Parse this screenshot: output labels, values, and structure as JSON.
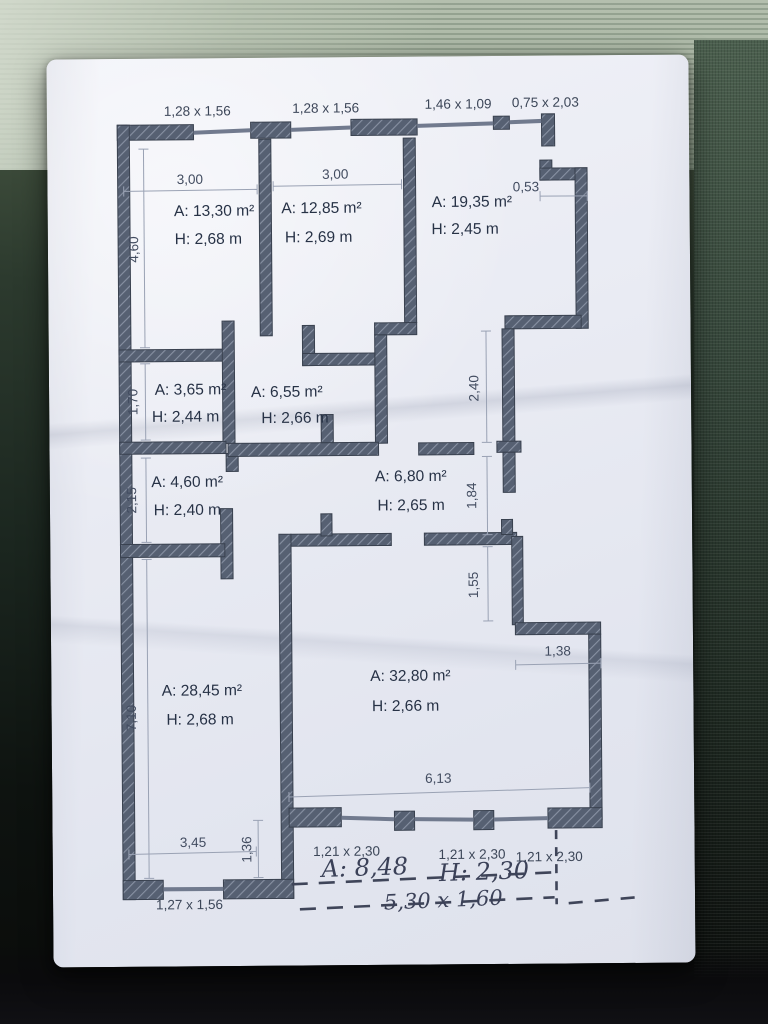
{
  "plan": {
    "top_windows": [
      "1,28 x 1,56",
      "1,28 x 1,56",
      "1,46 x 1,09",
      "0,75 x 2,03"
    ],
    "rooms": [
      {
        "area": "A: 13,30 m²",
        "height": "H: 2,68 m"
      },
      {
        "area": "A: 12,85 m²",
        "height": "H: 2,69 m"
      },
      {
        "area": "A: 19,35 m²",
        "height": "H: 2,45 m"
      },
      {
        "area": "A: 3,65 m²",
        "height": "H: 2,44 m"
      },
      {
        "area": "A: 6,55 m²",
        "height": "H: 2,66 m"
      },
      {
        "area": "A: 4,60 m²",
        "height": "H: 2,40 m"
      },
      {
        "area": "A: 6,80 m²",
        "height": "H: 2,65 m"
      },
      {
        "area": "A: 28,45 m²",
        "height": "H: 2,68 m"
      },
      {
        "area": "A: 32,80 m²",
        "height": "H: 2,66 m"
      }
    ],
    "dimensions": {
      "room1_width": "3,00",
      "room2_width": "3,00",
      "top_right_step": "0,53",
      "left_chain": [
        "4,60",
        "1,70",
        "2,15",
        "7,10"
      ],
      "right_chain": [
        "2,40",
        "1,84",
        "1,55"
      ],
      "right_step": "1,38",
      "room9_width": "6,13",
      "room8_width": "3,45",
      "bottom_step": "1,36"
    },
    "bottom_windows": [
      "1,21 x 2,30",
      "1,21 x 2,30",
      "1,21 x 2,30"
    ],
    "bottom_left_window": "1,27 x 1,56",
    "handwritten": {
      "area": "A: 8,48",
      "height": "H: 2,30",
      "size": "5,30 x 1,60"
    }
  },
  "colors": {
    "wall": "#566072",
    "hatch": "#8891a3",
    "paper": "#e9ebf3",
    "dim_line": "#9aa2b4"
  }
}
